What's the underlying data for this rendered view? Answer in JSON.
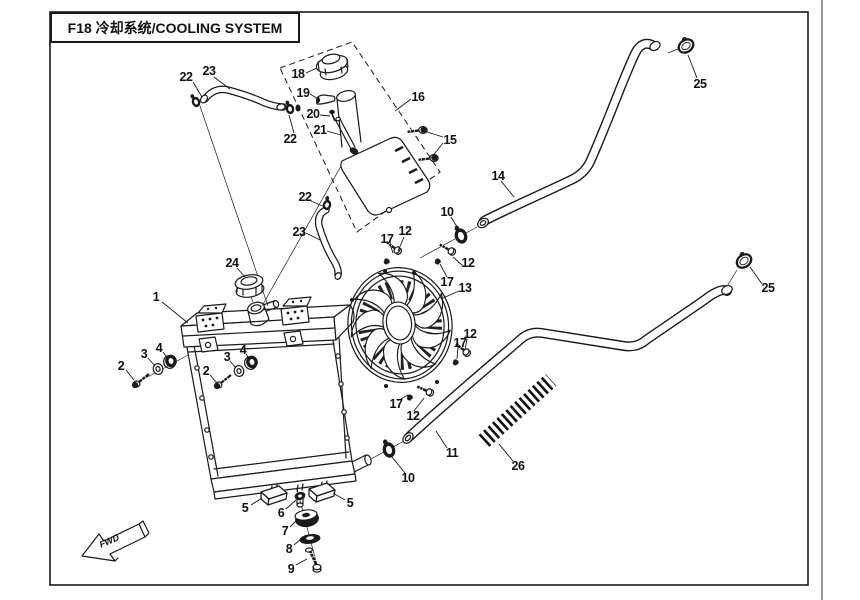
{
  "title": "F18 冷却系统/COOLING SYSTEM",
  "direction_arrow": {
    "label": "FWD"
  },
  "colors": {
    "ink": "#1a1a1a",
    "background": "#ffffff"
  },
  "callouts": [
    {
      "part": "22",
      "x": 186,
      "y": 77
    },
    {
      "part": "23",
      "x": 209,
      "y": 71
    },
    {
      "part": "18",
      "x": 298,
      "y": 74
    },
    {
      "part": "19",
      "x": 303,
      "y": 93
    },
    {
      "part": "20",
      "x": 313,
      "y": 114
    },
    {
      "part": "21",
      "x": 320,
      "y": 130
    },
    {
      "part": "16",
      "x": 418,
      "y": 97
    },
    {
      "part": "15",
      "x": 450,
      "y": 140
    },
    {
      "part": "22",
      "x": 290,
      "y": 139
    },
    {
      "part": "25",
      "x": 700,
      "y": 84
    },
    {
      "part": "14",
      "x": 498,
      "y": 176
    },
    {
      "part": "22",
      "x": 305,
      "y": 197
    },
    {
      "part": "23",
      "x": 299,
      "y": 232
    },
    {
      "part": "10",
      "x": 447,
      "y": 212
    },
    {
      "part": "17",
      "x": 387,
      "y": 239
    },
    {
      "part": "12",
      "x": 405,
      "y": 231
    },
    {
      "part": "12",
      "x": 468,
      "y": 263
    },
    {
      "part": "17",
      "x": 447,
      "y": 282
    },
    {
      "part": "13",
      "x": 465,
      "y": 288
    },
    {
      "part": "24",
      "x": 232,
      "y": 263
    },
    {
      "part": "1",
      "x": 156,
      "y": 297
    },
    {
      "part": "2",
      "x": 121,
      "y": 366
    },
    {
      "part": "3",
      "x": 144,
      "y": 354
    },
    {
      "part": "4",
      "x": 159,
      "y": 348
    },
    {
      "part": "2",
      "x": 206,
      "y": 371
    },
    {
      "part": "3",
      "x": 227,
      "y": 357
    },
    {
      "part": "4",
      "x": 243,
      "y": 350
    },
    {
      "part": "25",
      "x": 768,
      "y": 288
    },
    {
      "part": "12",
      "x": 470,
      "y": 334
    },
    {
      "part": "17",
      "x": 460,
      "y": 343
    },
    {
      "part": "17",
      "x": 396,
      "y": 404
    },
    {
      "part": "12",
      "x": 413,
      "y": 416
    },
    {
      "part": "11",
      "x": 452,
      "y": 453
    },
    {
      "part": "26",
      "x": 518,
      "y": 466
    },
    {
      "part": "10",
      "x": 408,
      "y": 478
    },
    {
      "part": "5",
      "x": 245,
      "y": 508
    },
    {
      "part": "6",
      "x": 281,
      "y": 513
    },
    {
      "part": "5",
      "x": 350,
      "y": 503
    },
    {
      "part": "7",
      "x": 285,
      "y": 531
    },
    {
      "part": "8",
      "x": 289,
      "y": 549
    },
    {
      "part": "9",
      "x": 291,
      "y": 569
    }
  ]
}
